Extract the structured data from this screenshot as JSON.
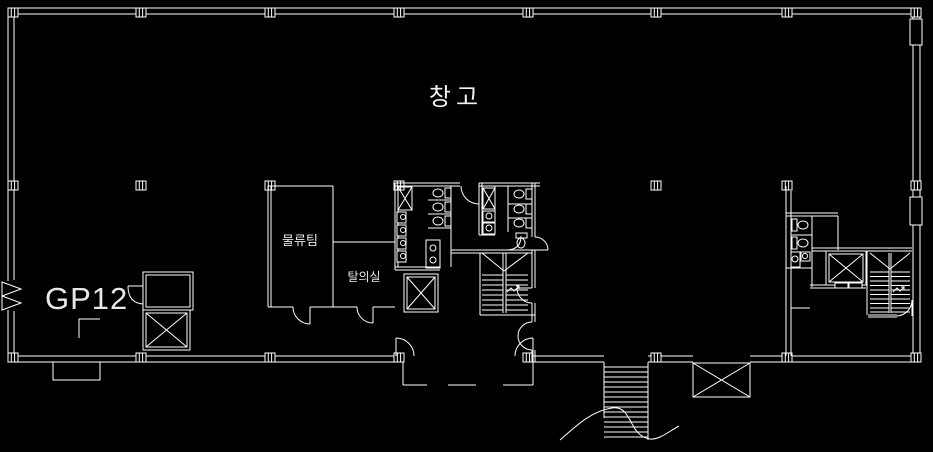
{
  "canvas": {
    "background": "#000000",
    "line_color": "#ffffff",
    "width": 933,
    "height": 452
  },
  "labels": {
    "warehouse": "창고",
    "logistics_team": "물류팀",
    "dressing_room": "탈의실",
    "gp12": "GP12"
  }
}
